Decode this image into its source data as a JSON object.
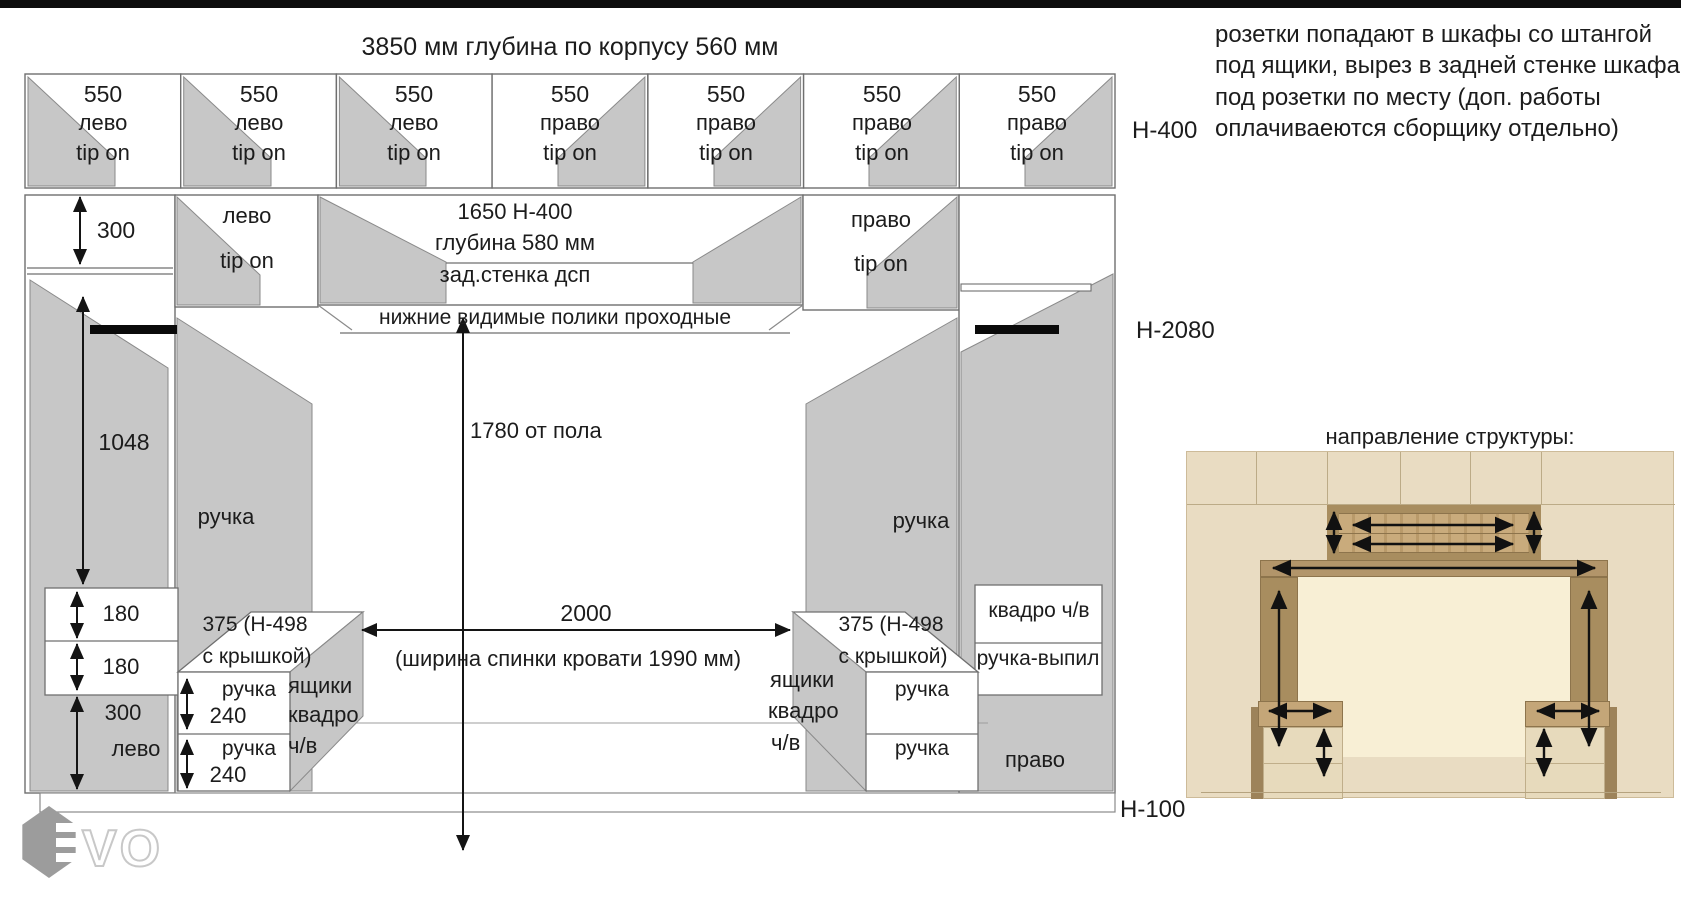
{
  "title": "3850 мм глубина по корпусу 560 мм",
  "note": {
    "line1": "розетки попадают в шкафы со штангой",
    "line2": "под ящики, вырез в задней стенке шкафа",
    "line3": "под розетки по месту (доп. работы",
    "line4": "оплачиваеются сборщику отдельно)"
  },
  "height_labels": {
    "h400": "Н-400",
    "h2080": "Н-2080",
    "h100": "Н-100"
  },
  "top_row": [
    {
      "size": "550",
      "side": "лево",
      "mech": "tip on"
    },
    {
      "size": "550",
      "side": "лево",
      "mech": "tip on"
    },
    {
      "size": "550",
      "side": "лево",
      "mech": "tip on"
    },
    {
      "size": "550",
      "side": "право",
      "mech": "tip on"
    },
    {
      "size": "550",
      "side": "право",
      "mech": "tip on"
    },
    {
      "size": "550",
      "side": "право",
      "mech": "tip on"
    },
    {
      "size": "550",
      "side": "право",
      "mech": "tip on"
    }
  ],
  "row2": {
    "dim_300": "300",
    "left_cell_side": "лево",
    "left_cell_mech": "tip on",
    "center_line1": "1650 Н-400",
    "center_line2": "глубина 580 мм",
    "center_line3": "зад.стенка дсп",
    "right_cell_side": "право",
    "right_cell_mech": "tip on"
  },
  "shelves_note": "нижние видимые полики проходные",
  "dims": {
    "d1048": "1048",
    "d1780": "1780 от пола",
    "d2000": "2000",
    "bed_note": "(ширина спинки кровати 1990 мм)",
    "d180a": "180",
    "d180b": "180",
    "d300_bottom": "300",
    "d240a": "240",
    "d240b": "240"
  },
  "left_col_side_bottom": "лево",
  "handles": {
    "left": "ручка",
    "right": "ручка"
  },
  "left_nightstand": {
    "cap_line1": "375 (Н-498",
    "cap_line2": "с крышкой)",
    "drawer1": "ручка",
    "drawer2": "ручка",
    "note1": "ящики",
    "note2": "квадро",
    "note3": "ч/в"
  },
  "right_nightstand": {
    "cap_line1": "375 (Н-498",
    "cap_line2": "с крышкой)",
    "drawer1": "ручка",
    "drawer2": "ручка",
    "note1": "ящики",
    "note2": "квадро",
    "note3": "ч/в"
  },
  "right_col": {
    "drawer_top": "квадро ч/в",
    "drawer_bottom": "ручка-выпил",
    "side": "право"
  },
  "structure_heading": "направление структуры:",
  "logo_text": "VO",
  "colors": {
    "panel_beige": "#e9dcc2",
    "niche_cream": "#f8efd5",
    "wood": "#a88d5f",
    "door_grey": "#c7c7c7",
    "rod_black": "#0a0a0a"
  }
}
